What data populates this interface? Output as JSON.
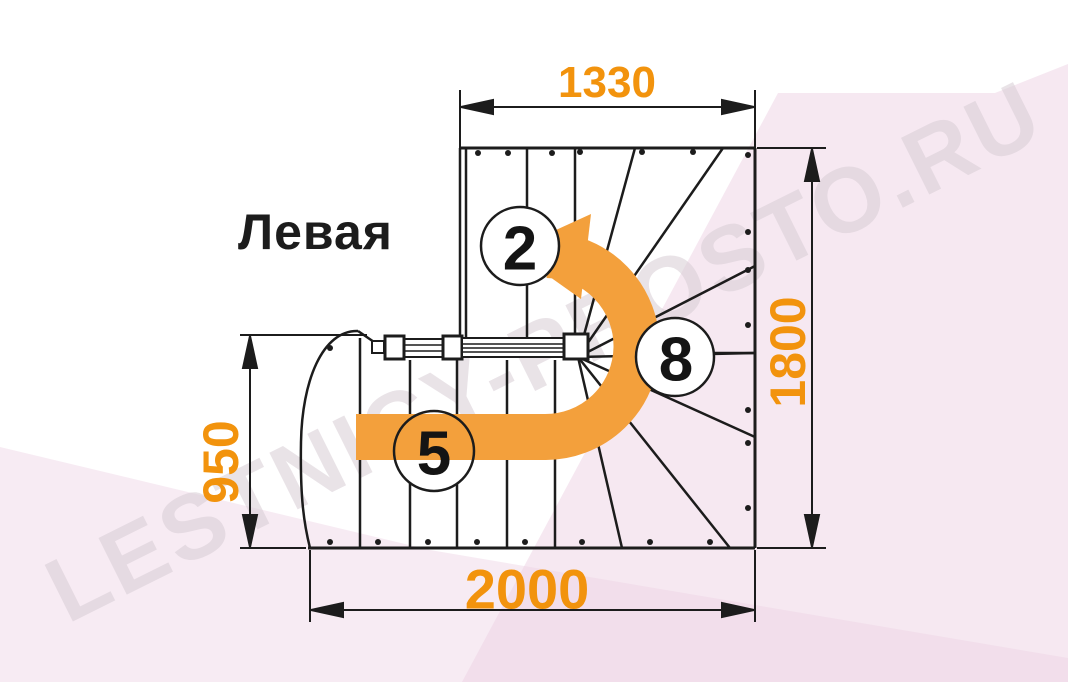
{
  "title": "Левая",
  "dimensions": {
    "top": "1330",
    "right": "1800",
    "left": "950",
    "bottom": "2000"
  },
  "step_labels": {
    "upper_flight_step": "2",
    "lower_flight_step": "5",
    "winder_step": "8"
  },
  "watermark": "LESTNICY-PROSTO.RU",
  "colors": {
    "dimension_text": "#f2930d",
    "direction_arrow": "#f3a03c",
    "drawing_line": "#1c1c1c",
    "watermark_text": "#d8cdd5",
    "background_tint": "#f7ecf3"
  }
}
